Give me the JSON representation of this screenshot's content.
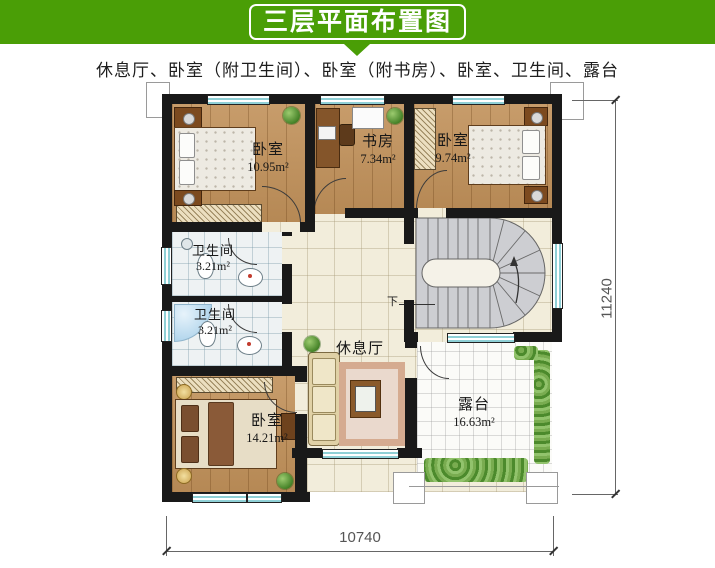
{
  "header": {
    "title": "三层平面布置图",
    "subtitle": "休息厅、卧室（附卫生间）、卧室（附书房）、卧室、卫生间、露台",
    "banner_color": "#4a9e06"
  },
  "plan": {
    "rooms": [
      {
        "id": "bedroom-top-left",
        "name": "卧室",
        "area": "10.95m²"
      },
      {
        "id": "study",
        "name": "书房",
        "area": "7.34m²"
      },
      {
        "id": "bedroom-top-right",
        "name": "卧室",
        "area": "9.74m²"
      },
      {
        "id": "bathroom-1",
        "name": "卫生间",
        "area": "3.21m²"
      },
      {
        "id": "bathroom-2",
        "name": "卫生间",
        "area": "3.21m²"
      },
      {
        "id": "bedroom-bottom-left",
        "name": "卧室",
        "area": "14.21m²"
      },
      {
        "id": "lounge",
        "name": "休息厅",
        "area": ""
      },
      {
        "id": "terrace",
        "name": "露台",
        "area": "16.63m²"
      }
    ],
    "stairs": {
      "direction_label": "下"
    },
    "dimensions": {
      "width": "10740",
      "height": "11240"
    }
  },
  "colors": {
    "wall": "#191919",
    "wood": "#c1915a",
    "window": "#8fd0d6"
  }
}
